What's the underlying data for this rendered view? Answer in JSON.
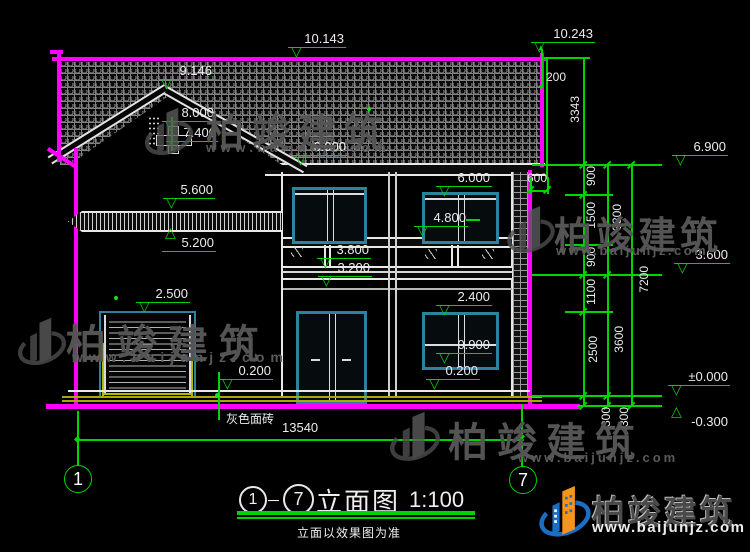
{
  "levels": {
    "l10143": "10.143",
    "l10243": "10.243",
    "l9146": "9.146",
    "l8000": "8.000",
    "l7400": "7.400",
    "l6900_roof": "6.900",
    "l6900_right": "6.900",
    "l6000": "6.000",
    "l5600": "5.600",
    "l5200": "5.200",
    "l4800": "4.800",
    "l3800": "3.800",
    "l3600": "3.600",
    "l3200": "3.200",
    "l2500": "2.500",
    "l2400": "2.400",
    "l0900": "0.900",
    "l0200_left": "0.200",
    "l0200_right": "0.200",
    "l0000": "±0.000",
    "lm0300": "-0.300"
  },
  "dims": {
    "d200": "200",
    "d600": "600",
    "d3343": "3343",
    "chain_inner": [
      "900",
      "1500",
      "900",
      "1100",
      "2500",
      "300"
    ],
    "chain_mid": [
      "3300",
      "3600",
      "300"
    ],
    "chain_outer": "7200",
    "width_total": "13540"
  },
  "axes": {
    "left": "1",
    "right": "7"
  },
  "labels": {
    "facade_material": "灰色面砖"
  },
  "title": {
    "axis_from": "1",
    "dash": "－",
    "axis_to": "7",
    "name": "立面图",
    "scale": "1:100",
    "note": "立面以效果图为准"
  },
  "watermark": {
    "name": "柏竣建筑",
    "url": "www.baijunjz.com"
  },
  "brand": {
    "name": "柏竣建筑",
    "url": "www.baijunjz.com"
  }
}
